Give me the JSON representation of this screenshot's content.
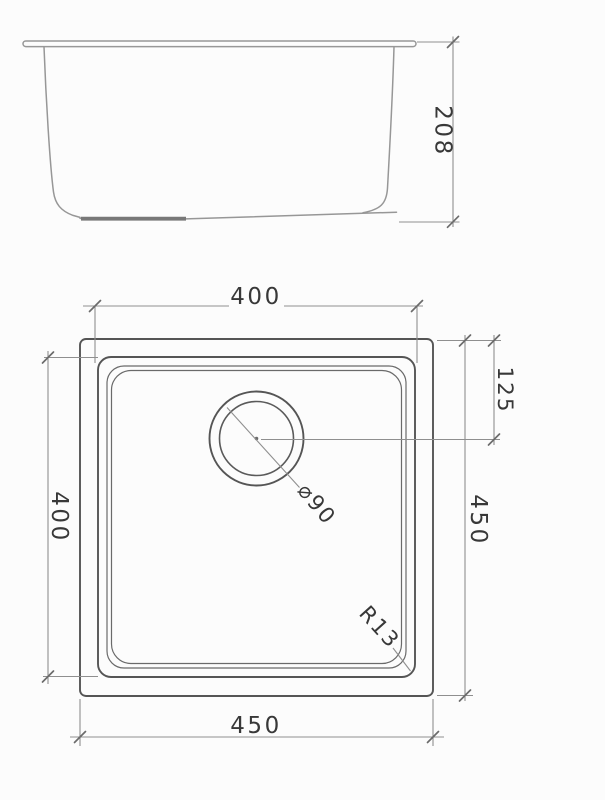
{
  "drawing": {
    "side_view": {
      "depth_label": "208"
    },
    "plan_view": {
      "bowl_width_label": "400",
      "bowl_length_label": "400",
      "overall_height_label": "450",
      "overall_width_label": "450",
      "drain_offset_label": "125",
      "drain_diameter_label": "⌀90",
      "corner_radius_label": "R13"
    },
    "colors": {
      "background": "#fcfcfc",
      "plan_object_line": "#555555",
      "side_object_line": "#979797",
      "dimension_line": "#8f8f8f",
      "tick": "#6b6b6b",
      "text": "#383838"
    }
  }
}
